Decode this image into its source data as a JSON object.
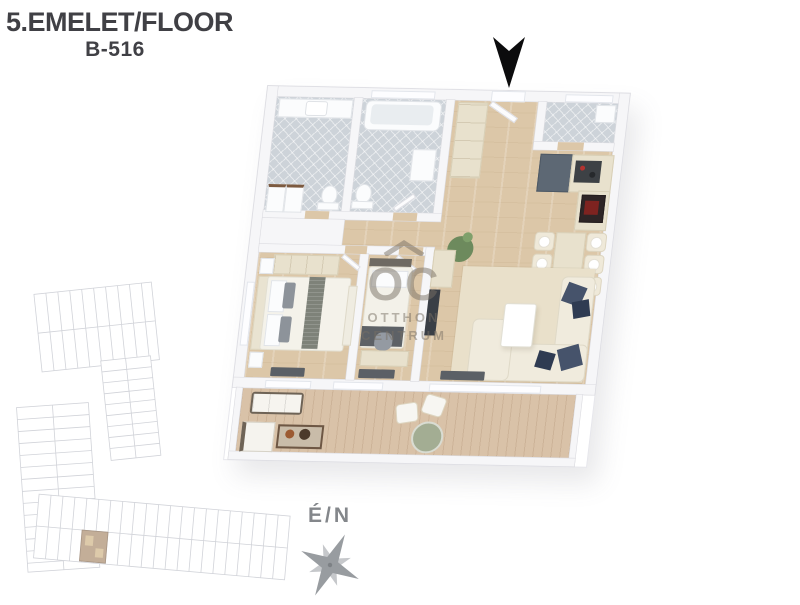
{
  "header": {
    "floor_label": "5.EMELET/FLOOR",
    "unit_label": "B-516"
  },
  "watermark": {
    "brand_initials": "OC",
    "brand_line1": "OTTHON",
    "brand_line2": "CENTRUM"
  },
  "compass": {
    "direction_label": "É/N"
  },
  "colors": {
    "title_gray": "#404045",
    "north_arrow_black": "#0c0c0d",
    "wood_floor": "#dcc7a8",
    "bathroom_tile": "#cdd3d9",
    "terrace_deck": "#d9c2a8",
    "wall_white": "#f6f6f8",
    "sofa_cream": "#efe9d9",
    "pillow_navy": "#46536b",
    "kitchen_dark_unit": "#5d6874",
    "oven_red": "#7e2320",
    "watermark_gray": "rgba(120,112,100,0.5)",
    "siteplan_line": "#b4b7c0",
    "siteplan_highlight_unit": "#9c7a55",
    "compass_gray": "#989ca0"
  }
}
